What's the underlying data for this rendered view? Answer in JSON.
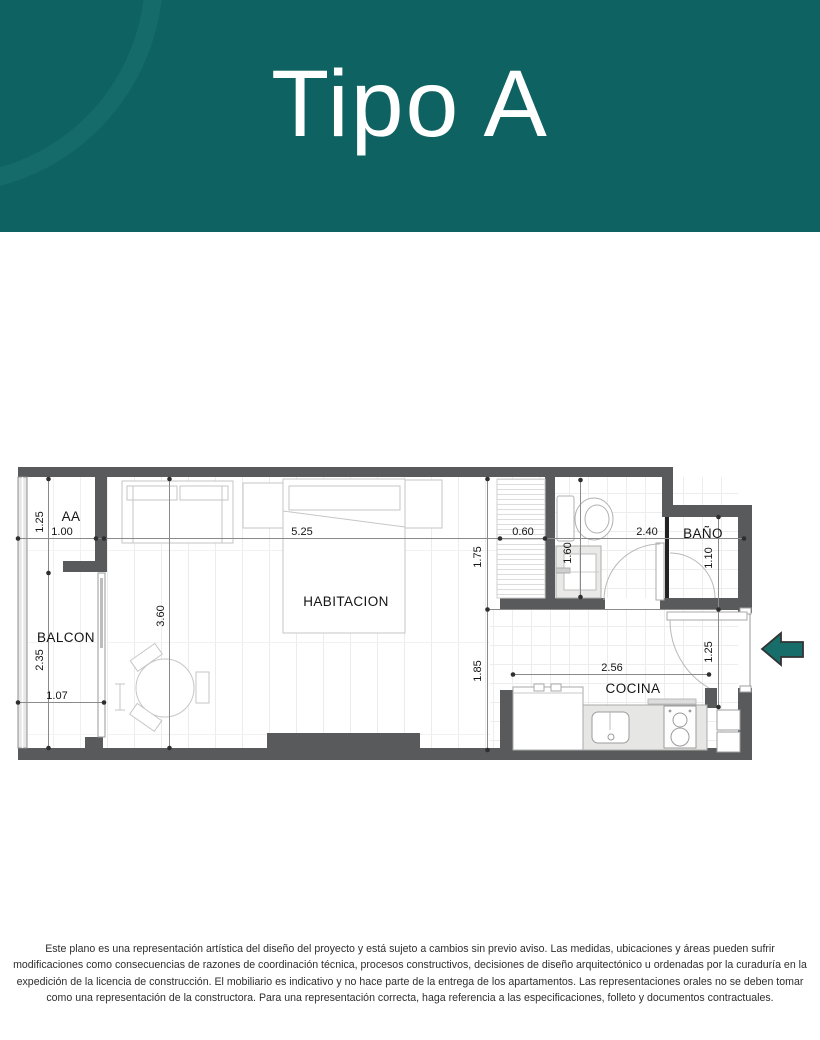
{
  "header": {
    "title": "Tipo A",
    "background_color": "#0e6261",
    "curve_color": "#146b6a",
    "text_color": "#ffffff"
  },
  "plan": {
    "rooms": {
      "aa": "AA",
      "balcon": "BALCON",
      "habitacion": "HABITACION",
      "bano": "BAÑO",
      "cocina": "COCINA"
    },
    "dims": {
      "aa_height": "1.25",
      "aa_width": "1.00",
      "balcon_height": "2.35",
      "balcon_door": "1.07",
      "hab_vertical": "3.60",
      "hab_width": "5.25",
      "closet_width": "0.60",
      "bath_width": "2.40",
      "bath_side": "1.60",
      "bath_depth": "1.75",
      "kitchen_depth": "1.85",
      "kitchen_width": "2.56",
      "nook_height": "1.10",
      "entry_height": "1.25"
    },
    "colors": {
      "wall": "#595a5c",
      "dimension_line": "#8a8a8a",
      "entry_arrow": "#176d69"
    }
  },
  "disclaimer": {
    "text": "Este plano es una representación artística del diseño del proyecto y está sujeto a cambios sin previo aviso. Las medidas, ubicaciones  y áreas pueden sufrir\nmodificaciones como consecuencias de razones de coordinación técnica, procesos constructivos,  decisiones de diseño arquitectónico u ordenadas por la curaduría en la\nexpedición de la licencia de construcción.  El mobiliario es indicativo y no hace parte de la entrega de los apartamentos. Las representaciones orales no se deben tomar\ncomo una representación de la constructora. Para una representación correcta, haga referencia a las especificaciones, folleto y documentos contractuales."
  }
}
